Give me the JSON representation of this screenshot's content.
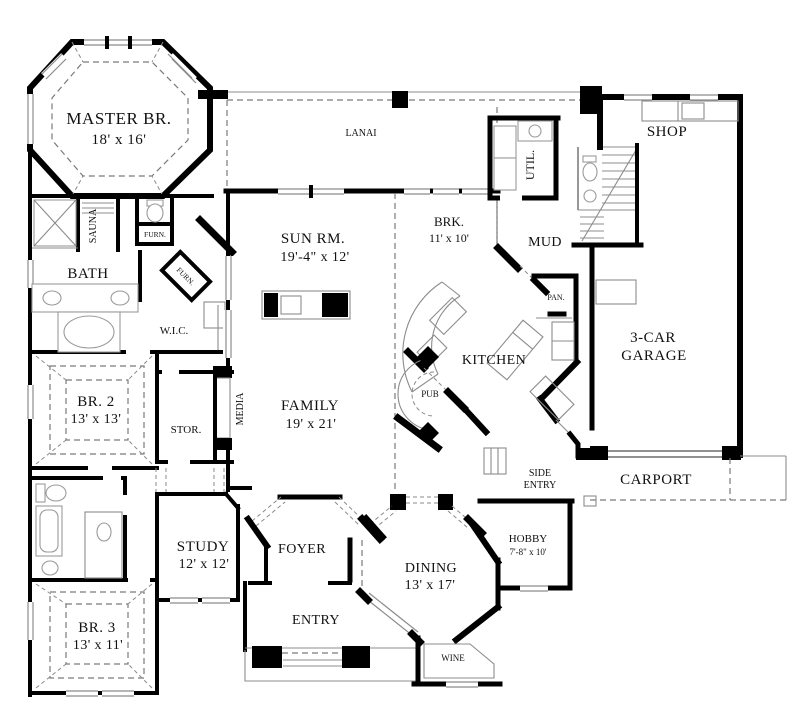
{
  "drawing": {
    "type": "house-first-floor-plan",
    "colors": {
      "wall": "#000000",
      "background": "#ffffff",
      "fixture_line": "#8c8c8c",
      "dashed_line": "#7a7a7a",
      "text": "#111111"
    }
  },
  "rooms": {
    "master": {
      "line1": "MASTER BR.",
      "line2": "18' x 16'"
    },
    "lanai": {
      "line1": "LANAI"
    },
    "shop": {
      "line1": "SHOP"
    },
    "util": {
      "line1": "UTIL."
    },
    "sauna": {
      "line1": "SAUNA"
    },
    "furn_closet": {
      "line1": "FURN."
    },
    "furn_angled": {
      "line1": "FURN."
    },
    "bath": {
      "line1": "BATH"
    },
    "sun_rm": {
      "line1": "SUN RM.",
      "line2": "19'-4\" x 12'"
    },
    "brk": {
      "line1": "BRK.",
      "line2": "11' x 10'"
    },
    "mud": {
      "line1": "MUD"
    },
    "pan": {
      "line1": "PAN."
    },
    "wic": {
      "line1": "W.I.C."
    },
    "kitchen": {
      "line1": "KITCHEN"
    },
    "pub": {
      "line1": "PUB"
    },
    "garage": {
      "line1": "3-CAR",
      "line2": "GARAGE"
    },
    "br2": {
      "line1": "BR. 2",
      "line2": "13' x 13'"
    },
    "stor": {
      "line1": "STOR."
    },
    "media": {
      "line1": "MEDIA"
    },
    "family": {
      "line1": "FAMILY",
      "line2": "19' x 21'"
    },
    "side_entry": {
      "line1": "SIDE",
      "line2": "ENTRY"
    },
    "carport": {
      "line1": "CARPORT"
    },
    "study": {
      "line1": "STUDY",
      "line2": "12' x 12'"
    },
    "foyer": {
      "line1": "FOYER"
    },
    "hobby": {
      "line1": "HOBBY",
      "line2": "7'-8\" x 10'"
    },
    "dining": {
      "line1": "DINING",
      "line2": "13' x 17'"
    },
    "br3": {
      "line1": "BR. 3",
      "line2": "13' x 11'"
    },
    "entry": {
      "line1": "ENTRY"
    },
    "wine": {
      "line1": "WINE"
    }
  }
}
